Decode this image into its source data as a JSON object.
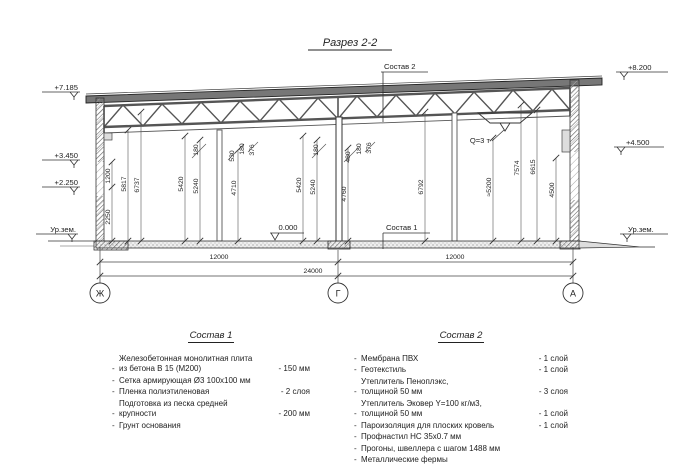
{
  "title": "Разрез 2-2",
  "callouts": {
    "roof_composition": "Состав 2",
    "floor_composition": "Состав 1",
    "hoist_capacity": "Q=3 т",
    "floor_level": "0.000"
  },
  "levels": {
    "left": [
      "+7.185",
      "+3.450",
      "+2.250",
      "Ур.зем."
    ],
    "right": [
      "+8.200",
      "+4.500",
      "Ур.зем."
    ]
  },
  "axes": [
    "Ж",
    "Г",
    "А"
  ],
  "dims": {
    "horizontal": [
      "12000",
      "24000",
      "12000"
    ],
    "vertical_left": [
      "2250",
      "1200",
      "5817",
      "6737",
      "5420",
      "5240",
      "4710"
    ],
    "vertical_right": [
      "5420",
      "5240",
      "4760",
      "6792",
      "≈5200",
      "7574",
      "6615",
      "4500"
    ],
    "top_left_group": [
      "180",
      "530",
      "180",
      "376"
    ],
    "top_center_group": [
      "180",
      "480",
      "180",
      "376"
    ]
  },
  "legend1": {
    "heading": "Состав 1",
    "bullet": "-",
    "items": [
      {
        "text": "Железобетонная монолитная плита\nиз бетона В 15 (М200)",
        "value": "- 150 мм"
      },
      {
        "text": "Сетка армирующая Ø3 100х100 мм",
        "value": ""
      },
      {
        "text": "Пленка полиэтиленовая",
        "value": "- 2 слоя"
      },
      {
        "text": "Подготовка из песка средней\nкрупности",
        "value": "- 200 мм"
      },
      {
        "text": "Грунт основания",
        "value": ""
      }
    ]
  },
  "legend2": {
    "heading": "Состав 2",
    "bullet": "-",
    "items": [
      {
        "text": "Мембрана ПВХ",
        "value": "- 1 слой"
      },
      {
        "text": "Геотекстиль",
        "value": "- 1 слой"
      },
      {
        "text": "Утеплитель Пеноплэкс,\nтолщиной 50 мм",
        "value": "- 3 слоя"
      },
      {
        "text": "Утеплитель Эковер Y=100 кг/м3,\nтолщиной 50 мм",
        "value": "- 1 слой"
      },
      {
        "text": "Пароизоляция для плоских кровель",
        "value": "- 1 слой"
      },
      {
        "text": "Профнастил НС 35х0.7 мм",
        "value": ""
      },
      {
        "text": "Прогоны, швеллера с шагом 1488 мм",
        "value": ""
      },
      {
        "text": "Металлические фермы",
        "value": ""
      }
    ]
  }
}
